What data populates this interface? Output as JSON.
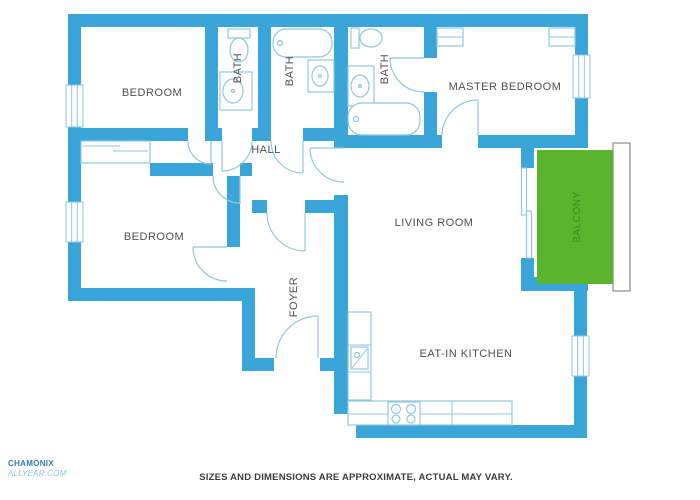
{
  "colors": {
    "wall": "#3aa5d8",
    "fixture": "#8fc7e1",
    "label": "#4e4e4e",
    "balcony": "#5ab42e",
    "balcony_text": "#3f8c1f",
    "railing": "#8c8c8c",
    "logo1": "#2d7cb5",
    "logo2": "#86c8e6",
    "disclaimer": "#3c3c3c"
  },
  "rooms": {
    "bedroom1": "BEDROOM",
    "bath1": "BATH",
    "bath2": "BATH",
    "bath3": "BATH",
    "master_bedroom": "MASTER BEDROOM",
    "hall": "HALL",
    "bedroom2": "BEDROOM",
    "foyer": "FOYER",
    "living_room": "LIVING ROOM",
    "eat_in_kitchen": "EAT-IN KITCHEN",
    "balcony": "BALCONY"
  },
  "footer": {
    "disclaimer": "SIZES AND DIMENSIONS ARE APPROXIMATE, ACTUAL MAY VARY."
  },
  "logo": {
    "line1": "CHAMONIX",
    "line2": "ALLYEAR.COM"
  }
}
